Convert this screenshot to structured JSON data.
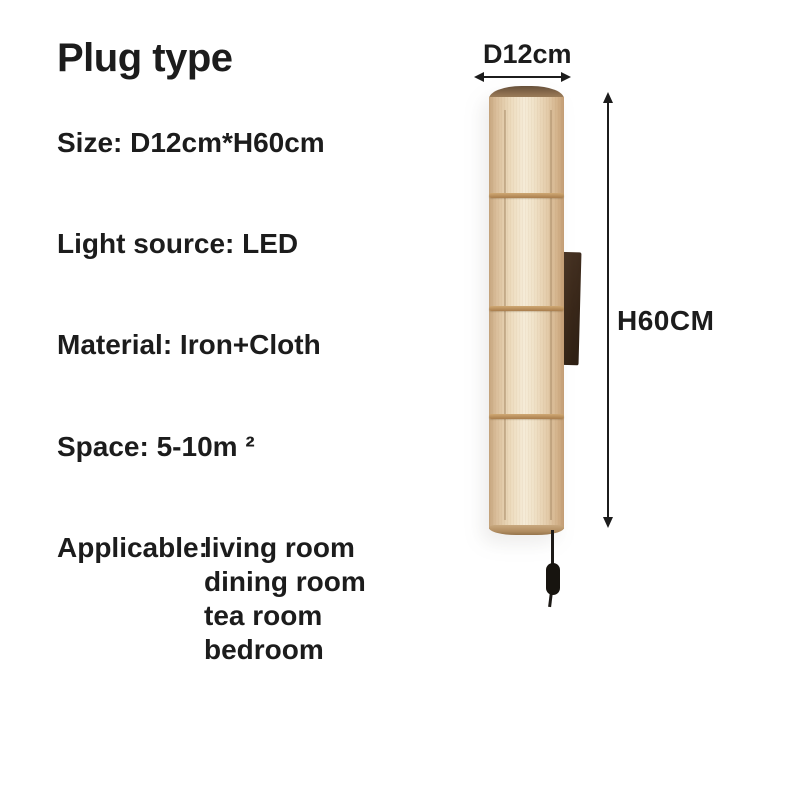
{
  "header": {
    "title": "Plug type"
  },
  "specs": {
    "size": "Size: D12cm*H60cm",
    "light_source": "Light source: LED",
    "material": "Material: Iron+Cloth",
    "space": "Space: 5-10m ²",
    "applicable_label": "Applicable:",
    "applicable_values": [
      "living room",
      "dining room",
      "tea room",
      "bedroom"
    ]
  },
  "dimensions": {
    "diameter_label": "D12cm",
    "height_label": "H60CM"
  },
  "figure": {
    "description": "cylindrical beige fabric wall lamp with dark wall bracket and pull-cord switch"
  },
  "colors": {
    "background": "#ffffff",
    "text": "#1c1c1c",
    "arrow": "#1c1c1c",
    "fabric-light": "#f5ebd7",
    "fabric-mid": "#e8d4b4",
    "fabric-shade": "#c5a47d",
    "band": "#b08352",
    "rim": "#8d6f4f",
    "bracket": "#3a281a",
    "cord": "#1d1a17"
  }
}
